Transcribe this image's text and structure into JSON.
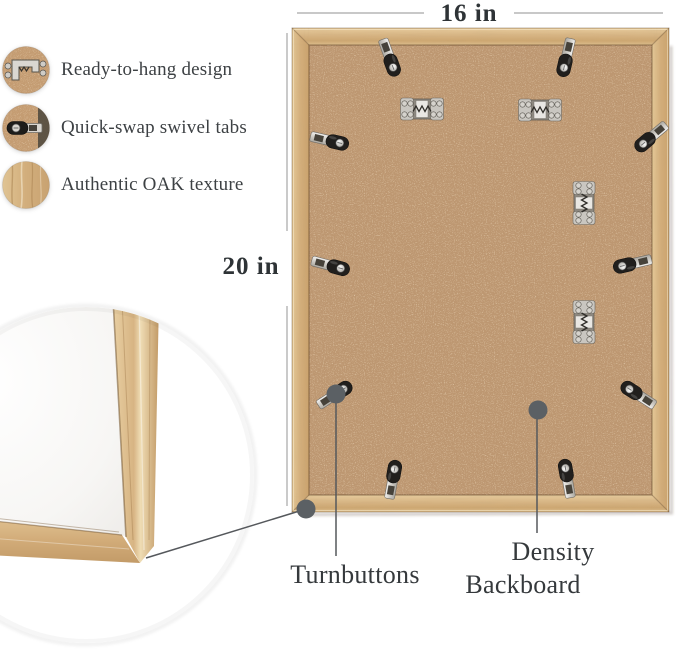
{
  "product_view": "picture-frame-back-annotated",
  "dimensions": {
    "width_label": "16 in",
    "height_label": "20 in"
  },
  "features": [
    {
      "icon": "sawtooth-hanger-icon",
      "label": "Ready-to-hang design"
    },
    {
      "icon": "swivel-tab-icon",
      "label": "Quick-swap swivel tabs"
    },
    {
      "icon": "oak-texture-icon",
      "label": "Authentic OAK texture"
    }
  ],
  "callouts": {
    "turnbuttons_label": "Turnbuttons",
    "backboard_line1": "Density",
    "backboard_line2": "Backboard"
  },
  "hardware": {
    "turnbutton_count": 10,
    "sawtooth_hanger_count": 4
  },
  "colors": {
    "background": "#ffffff",
    "backboard_mdf": "#bd9771",
    "oak_wood": "#d9b988",
    "annotation_dot": "#5b6064",
    "leader_line": "#55585c",
    "dimension_line": "#a6a6a6",
    "text": "#35393c"
  }
}
